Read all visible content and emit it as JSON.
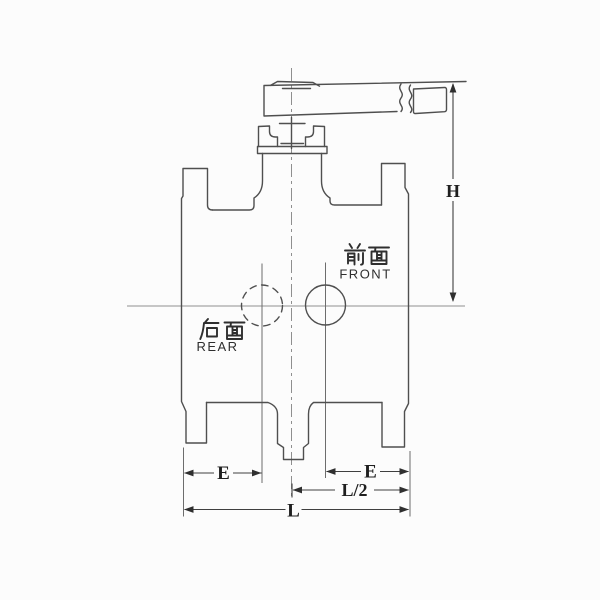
{
  "figure": {
    "type": "engineering-drawing",
    "subject": "flanged ball valve front elevation with lever handle",
    "colors": {
      "background": "#fcfcfc",
      "outline": "#4f4f4f",
      "centerline": "#8f8f8f",
      "dimension_line": "#3f3f3f",
      "text": "#2f2f2f"
    }
  },
  "labels": {
    "front_cn": "前面",
    "front_en": "FRONT",
    "rear_cn": "后面",
    "rear_en": "REAR"
  },
  "dimensions": {
    "height": "H",
    "e_left": "E",
    "e_right": "E",
    "half_length": "L/2",
    "overall_length": "L"
  }
}
